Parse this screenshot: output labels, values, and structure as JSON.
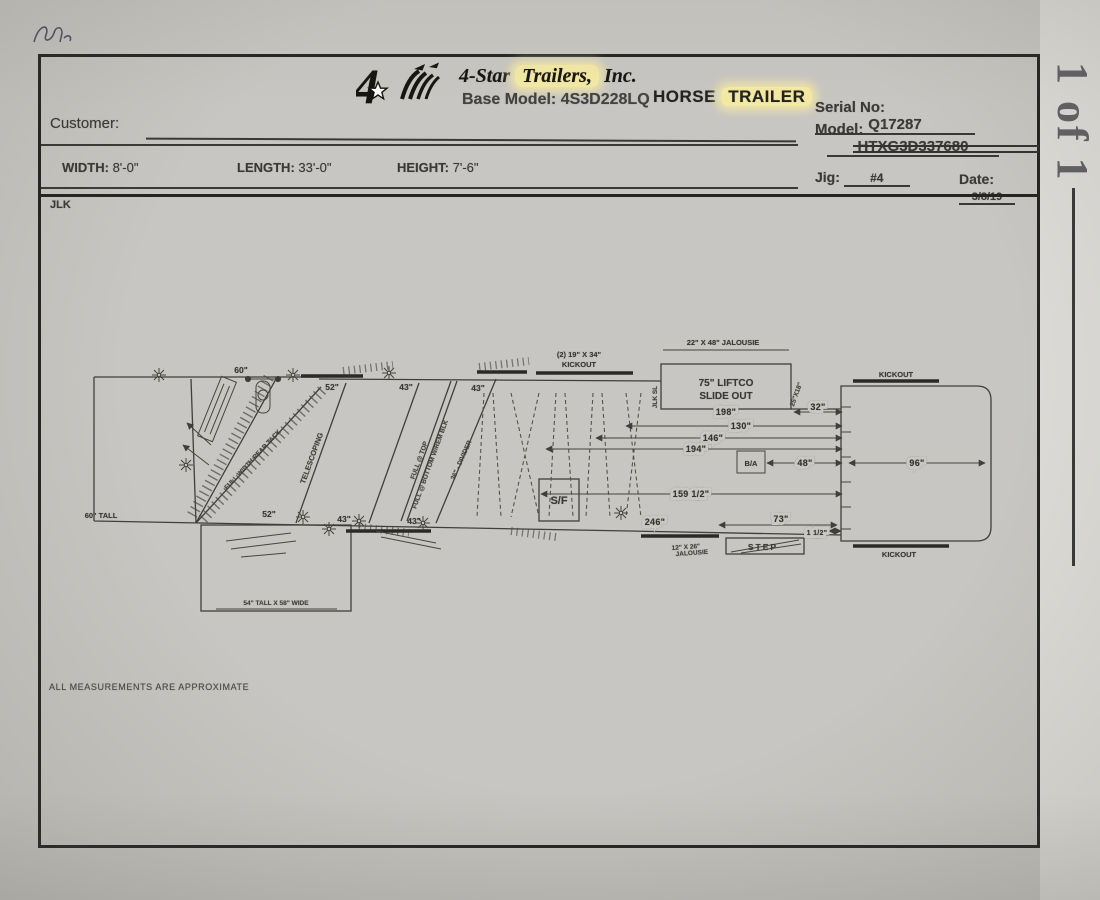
{
  "colors": {
    "paper": "#c9c8c4",
    "ink": "#3a3936",
    "highlight_yellow": "#f3e9a4"
  },
  "scan": {
    "sheet_label": "1 of 1"
  },
  "header": {
    "company_pre": "4-Star ",
    "company_hl": "Trailers,",
    "company_post": " Inc.",
    "base_model_label": "Base Model:",
    "base_model_value": "4S3D228LQ",
    "type_word": "HORSE",
    "type_hl": "TRAILER",
    "serial_label": "Serial No:",
    "serial_value": "Q17287",
    "model_label": "Model:",
    "model_value": "HTXG3D337680"
  },
  "info": {
    "customer_label": "Customer:",
    "width_label": "WIDTH:",
    "width_value": "8'-0\"",
    "length_label": "LENGTH:",
    "length_value": "33'-0\"",
    "height_label": "HEIGHT:",
    "height_value": "7'-6\"",
    "jig_label": "Jig:",
    "jig_value": "#4",
    "date_label": "Date:",
    "date_value": "3/8/19",
    "drafter_initials": "JLK"
  },
  "drawing": {
    "labels": {
      "front_width": "60\"",
      "front_height": "60\" TALL",
      "stall1_top": "52\"",
      "stall1_bottom": "52\"",
      "stall2_top": "43\"",
      "stall3_top": "43\"",
      "stall2_bottom": "43\"",
      "stall3_bottom": "43\"",
      "divider1": "TELESCOPING",
      "divider2a": "FULL @ TOP",
      "divider2b": "FULL @ BOTTOM W/REM BLK",
      "divider3": "36\" - DIVIDER",
      "tack_note": "FULL WIDTH REAR TACK",
      "sf": "S/F",
      "ba": "B/A",
      "step": "STEP",
      "kickout_front_line1": "(2) 19\" X 34\"",
      "kickout_front_line2": "KICKOUT",
      "jalousie_top": "22\" X 48\" JALOUSIE",
      "slideout_line1": "75\" LIFTCO",
      "slideout_line2": "SLIDE OUT",
      "slideout_left_note": "JLK SL",
      "slideout_right_note": "25\"X18\"",
      "jalousie_bottom_line1": "12\" X 26\"",
      "jalousie_bottom_line2": "JALOUSIE",
      "kickout_rear_top": "KICKOUT",
      "kickout_rear_bottom": "KICKOUT",
      "dress_box": "54\" TALL X 58\" WIDE"
    },
    "dims": {
      "d198": "198\"",
      "d32": "32\"",
      "d130": "130\"",
      "d146": "146\"",
      "d194": "194\"",
      "d48": "48\"",
      "d96": "96\"",
      "d159": "159 1/2\"",
      "d246": "246\"",
      "d73": "73\"",
      "d15": "1 1/2\""
    }
  },
  "footer": {
    "note": "ALL MEASUREMENTS ARE APPROXIMATE"
  }
}
